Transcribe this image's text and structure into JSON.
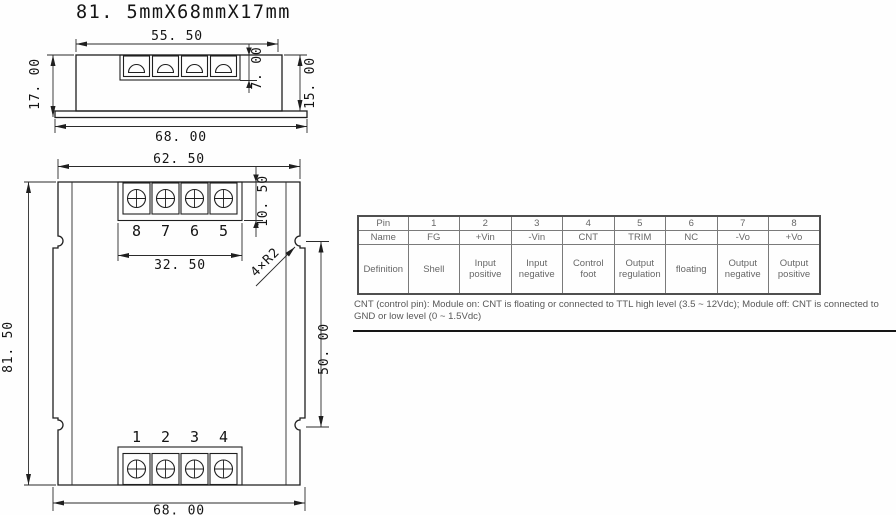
{
  "title": "81. 5mmX68mmX17mm",
  "side_view": {
    "dim_terminal_width": "55. 50",
    "dim_terminal_height": "7. 00",
    "dim_total_height": "17. 00",
    "dim_body_height": "15. 00",
    "dim_base_width": "68. 00"
  },
  "top_view": {
    "dim_top_width": "62. 50",
    "dim_terminal_depth": "10. 50",
    "dim_terminal_span": "32. 50",
    "dim_body_length": "81. 50",
    "dim_notch_spacing": "50. 00",
    "dim_base_width": "68. 00",
    "corner_note": "4×R2",
    "top_pins": [
      "8",
      "7",
      "6",
      "5"
    ],
    "bottom_pins": [
      "1",
      "2",
      "3",
      "4"
    ]
  },
  "pin_table": {
    "row_labels": [
      "Pin",
      "Name",
      "Definition"
    ],
    "pins": [
      "1",
      "2",
      "3",
      "4",
      "5",
      "6",
      "7",
      "8"
    ],
    "names": [
      "FG",
      "+Vin",
      "-Vin",
      "CNT",
      "TRIM",
      "NC",
      "-Vo",
      "+Vo"
    ],
    "definitions": [
      "Shell",
      "Input positive",
      "Input negative",
      "Control foot",
      "Output regulation",
      "floating",
      "Output negative",
      "Output positive"
    ]
  },
  "note": "CNT (control pin): Module on: CNT is floating or connected to TTL high level (3.5 ~ 12Vdc); Module off: CNT is connected to GND or low level (0 ~ 1.5Vdc)",
  "colors": {
    "drawing_line": "#1f1f1f",
    "dimension_text": "#141414",
    "table_border": "#7a7a7a",
    "table_text": "#676767",
    "note_text": "#585858",
    "background": "#fefefe"
  }
}
